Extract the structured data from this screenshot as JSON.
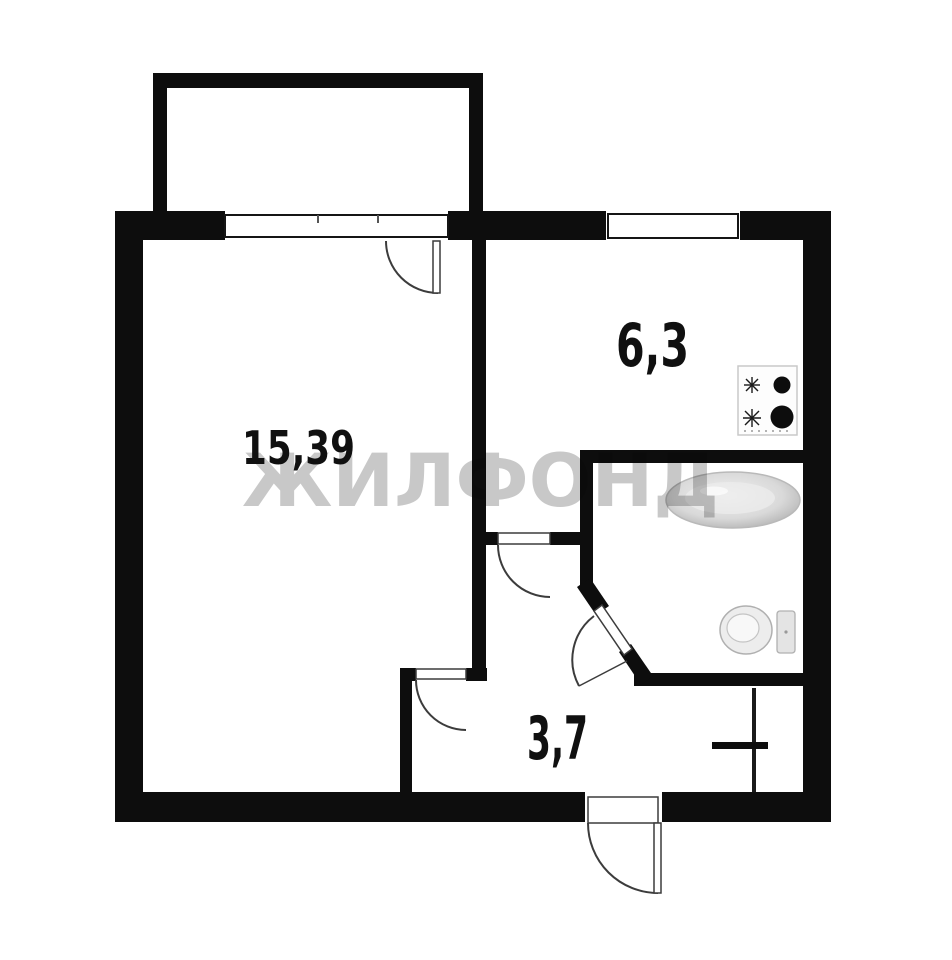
{
  "floorplan": {
    "watermark_text": "ЖИЛФОНД",
    "rooms": [
      {
        "id": "living-room",
        "area_label": "15,39"
      },
      {
        "id": "kitchen",
        "area_label": "6,3"
      },
      {
        "id": "hallway",
        "area_label": "3,7"
      }
    ],
    "fixtures": [
      {
        "icon": "stove-icon"
      },
      {
        "icon": "bathtub-icon"
      },
      {
        "icon": "toilet-icon"
      }
    ],
    "colors": {
      "wall": "#0d0d0d",
      "background": "#ffffff",
      "watermark": "#c8c8c8",
      "door_stroke": "#3c3c3c"
    }
  }
}
